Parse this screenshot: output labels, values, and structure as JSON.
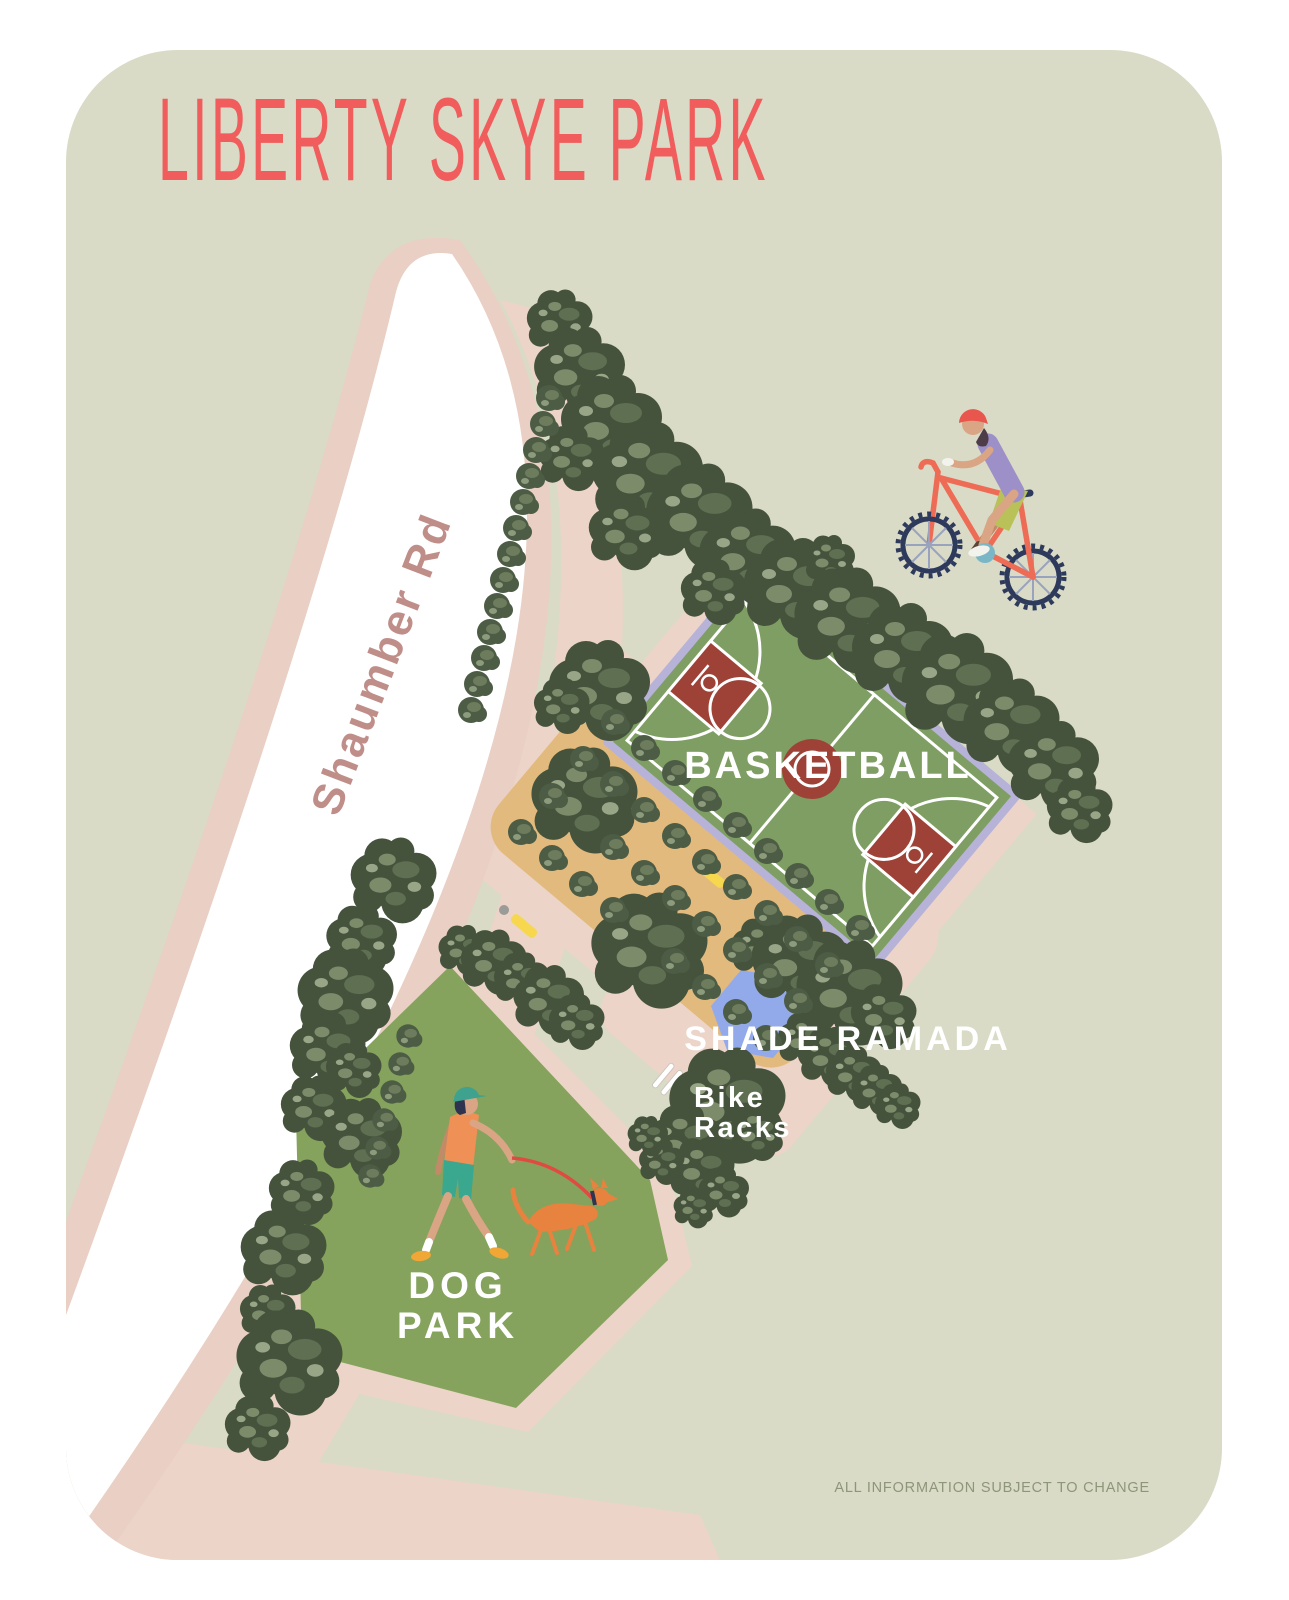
{
  "title": "LIBERTY SKYE PARK",
  "road": {
    "label": "Shaumber Rd"
  },
  "labels": {
    "basketball": "BASKETBALL",
    "shade_ramada": "SHADE RAMADA",
    "bike_racks_line1": "Bike",
    "bike_racks_line2": "Racks",
    "dog_park_line1": "DOG",
    "dog_park_line2": "PARK"
  },
  "footer": {
    "disclaimer": "ALL INFORMATION SUBJECT TO CHANGE"
  },
  "illustrations": {
    "cyclist": "person-on-red-bicycle-icon",
    "dog_walker": "person-walking-dog-icon",
    "bike_racks": "striped-rack-icon",
    "shade_ramada": "blue-hexagon-shelter",
    "bench": "yellow-bench-icon",
    "trash_can": "gray-dot-icon",
    "tree": "green-tree-cluster-icon"
  },
  "colors": {
    "page_bg": "#ffffff",
    "park_bg": "#d9dbc6",
    "road_fill": "#ffffff",
    "road_casing_pink": "#e9cfc4",
    "path_pink": "#ecd4c8",
    "court_green": "#7f9e63",
    "court_red": "#9e4238",
    "court_border_lavender": "#b7b2d8",
    "orchard_tan": "#e3ba7e",
    "dog_park_green": "#85a35c",
    "ramada_blue": "#93aaea",
    "tree_dark": "#45533d",
    "tree_mid": "#5e6f52",
    "tree_light": "#7c8b6a",
    "bench_yellow": "#f6d74d",
    "title_coral": "#f15d5c",
    "road_text": "#c08e89",
    "label_white": "#ffffff",
    "disclaimer_gray": "#8e957a"
  }
}
